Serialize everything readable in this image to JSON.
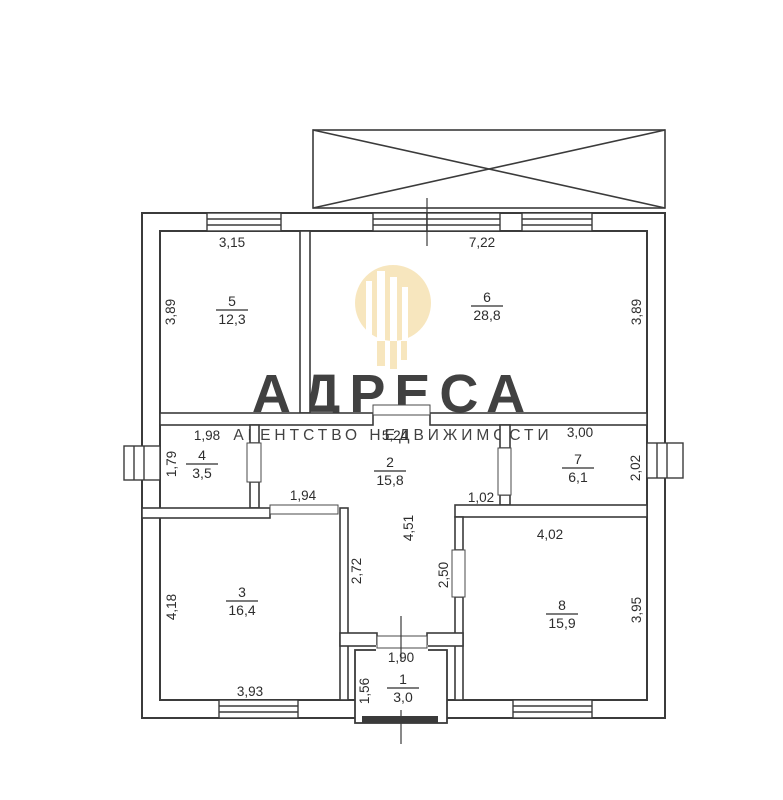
{
  "watermark": {
    "brand": "АДРЕСА",
    "subtitle": "АГЕНТСТВО НЕДВИЖИМОСТИ",
    "brand_color": "#f2d9a2",
    "subtitle_color": "#f1e3c4"
  },
  "colors": {
    "wall_line": "#3b3b3b",
    "text": "#2d2d2d",
    "threshold": "#3a3a3a"
  },
  "rooms": {
    "r1": {
      "num": "1",
      "area": "3,0"
    },
    "r2": {
      "num": "2",
      "area": "15,8"
    },
    "r3": {
      "num": "3",
      "area": "16,4"
    },
    "r4": {
      "num": "4",
      "area": "3,5"
    },
    "r5": {
      "num": "5",
      "area": "12,3"
    },
    "r6": {
      "num": "6",
      "area": "28,8"
    },
    "r7": {
      "num": "7",
      "area": "6,1"
    },
    "r8": {
      "num": "8",
      "area": "15,9"
    }
  },
  "dims": {
    "top_room5": "3,15",
    "top_room6": "7,22",
    "left_room5": "3,89",
    "right_room6": "3,89",
    "top_room4": "1,98",
    "top_hall": "5,24",
    "top_room7": "3,00",
    "left_room4": "1,79",
    "right_room7": "2,02",
    "hall_door3": "1,94",
    "hall_step8": "1,02",
    "hall_depth": "4,51",
    "top_room8": "4,02",
    "corridor_left": "2,72",
    "corridor_right": "2,50",
    "left_room3": "4,18",
    "right_room8": "3,95",
    "bottom_room3": "3,93",
    "top_room1": "1,90",
    "left_room1": "1,56"
  }
}
